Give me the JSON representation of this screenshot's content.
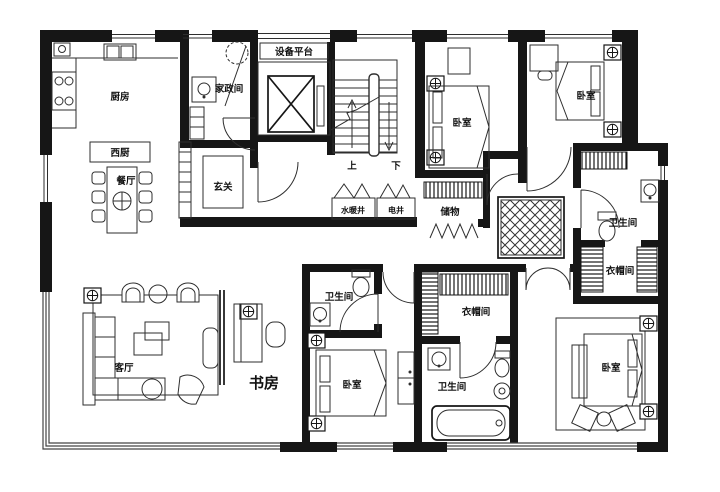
{
  "floor_plan": {
    "type": "apartment-floor-plan",
    "rooms": {
      "kitchen": "厨房",
      "west_kitchen": "西厨",
      "dining": "餐厅",
      "housekeeping": "家政间",
      "equipment_platform": "设备平台",
      "foyer": "玄关",
      "stairs_up": "上",
      "stairs_down": "下",
      "plumbing_shaft": "水暖井",
      "electrical_shaft": "电井",
      "storage": "储物",
      "bedroom_top_middle": "卧室",
      "bedroom_top_right": "卧室",
      "bathroom_right": "卫生间",
      "cloakroom_right": "衣帽间",
      "living_room": "客厅",
      "study": "书房",
      "bathroom_mid": "卫生间",
      "bedroom_bottom_middle": "卧室",
      "cloakroom_bottom": "衣帽间",
      "bathroom_bottom": "卫生间",
      "bedroom_bottom_right": "卧室"
    },
    "colors": {
      "wall": "#161616",
      "line": "#2e2e2e",
      "background": "#ffffff"
    }
  }
}
